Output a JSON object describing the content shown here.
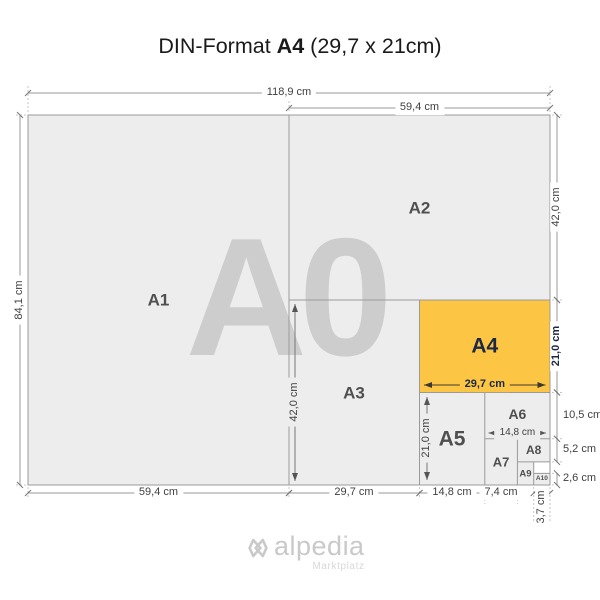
{
  "title": {
    "prefix": "DIN-Format",
    "format": "A4",
    "size": "(29,7 x 21cm)"
  },
  "watermark": "A0",
  "papers": {
    "a1": "A1",
    "a2": "A2",
    "a3": "A3",
    "a4": "A4",
    "a5": "A5",
    "a6": "A6",
    "a7": "A7",
    "a8": "A8",
    "a9": "A9",
    "a10": "A10"
  },
  "dimensions": {
    "width_a0": "118,9 cm",
    "width_a2_top": "59,4 cm",
    "height_a0": "84,1 cm",
    "height_a2": "42,0 cm",
    "height_a4": "21,0 cm",
    "height_a6": "10,5 cm",
    "height_a8": "5,2 cm",
    "height_a10": "2,6 cm",
    "width_a1": "59,4 cm",
    "width_a3": "29,7 cm",
    "width_a5": "14,8 cm",
    "width_a7": "7,4 cm",
    "width_a9": "3,7 cm",
    "inner_height_a3": "42,0 cm",
    "inner_width_a4": "29,7 cm",
    "inner_height_a5": "21,0 cm",
    "inner_width_a6": "14,8 cm"
  },
  "logo": {
    "name": "alpedia",
    "tagline": "Marktplatz"
  },
  "colors": {
    "highlight_fill": "#FDC544",
    "highlight_text": "#1B2945",
    "paper_fill": "#EDEDED",
    "line_gray": "#9A9A9A",
    "dim_text": "#3F3F3F",
    "watermark": "#CDCDCD",
    "logo_gray": "#C9C9C9"
  }
}
